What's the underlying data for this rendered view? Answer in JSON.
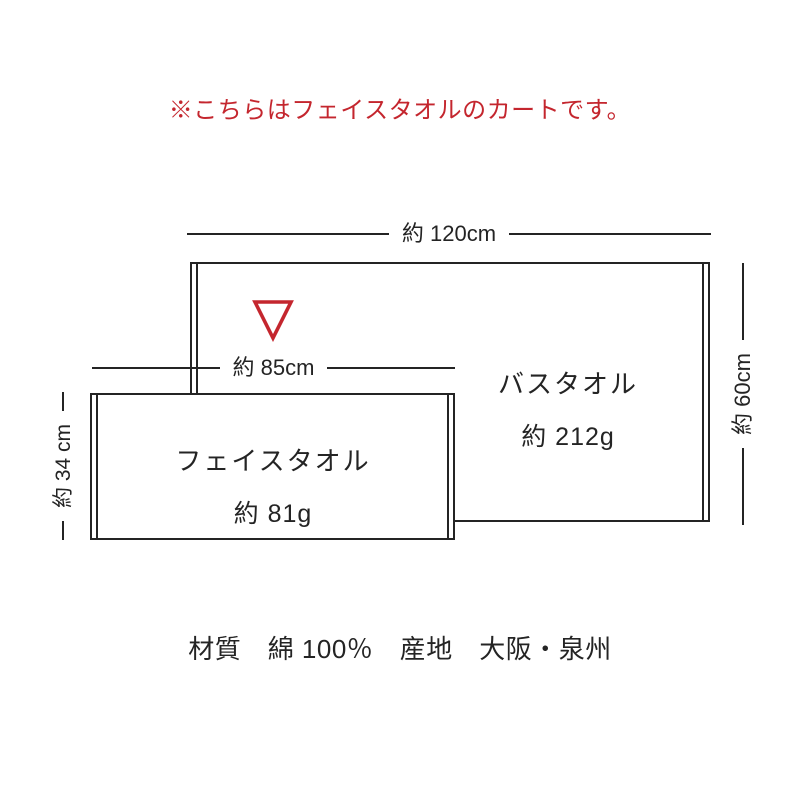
{
  "notice": {
    "text": "※こちらはフェイスタオルのカートです。"
  },
  "diagram": {
    "bath_towel": {
      "label": "バスタオル",
      "weight": "約 212g",
      "width_dimension": "約 120cm",
      "height_dimension": "約 60cm"
    },
    "face_towel": {
      "label": "フェイスタオル",
      "weight": "約 81g",
      "width_dimension": "約 85cm",
      "height_dimension": "約 34 cm"
    },
    "marker": {
      "shape": "triangle-down-outline",
      "color": "#c4262e"
    }
  },
  "footer": {
    "text": "材質　綿 100％　産地　大阪・泉州"
  },
  "colors": {
    "accent_red": "#c4262e",
    "line": "#242424",
    "text": "#242424",
    "background": "#ffffff"
  }
}
